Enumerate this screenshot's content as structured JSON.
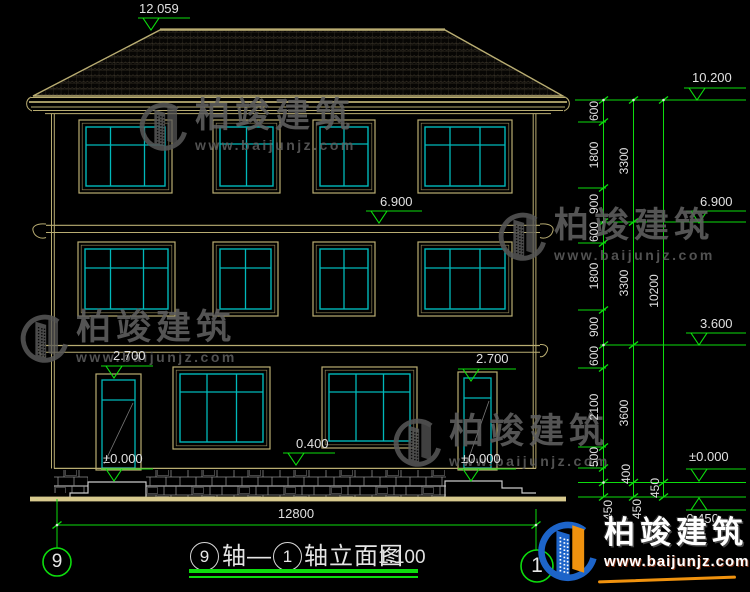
{
  "meta": {
    "kind": "architectural elevation CAD drawing"
  },
  "levels": {
    "ridge": "12.059",
    "eave": "10.200",
    "floor3": "6.900",
    "floor3_right": "6.900",
    "floor2_right": "3.600",
    "door_left": "2.700",
    "door_right": "2.700",
    "sill": "0.400",
    "zero_left": "±0.000",
    "zero_door_right": "±0.000",
    "zero_right": "±0.000",
    "below_ground": "-0.450"
  },
  "dims": {
    "overall_width": "12800",
    "chain_inner": [
      "600",
      "1800",
      "900",
      "600",
      "1800",
      "900",
      "600",
      "2100",
      "500",
      "450"
    ],
    "chain_middle": [
      "3300",
      "3300",
      "3600",
      "400",
      "450"
    ],
    "chain_outer": [
      "10200",
      "450"
    ]
  },
  "axes": {
    "left": "9",
    "right": "1"
  },
  "title": {
    "bubble_left": "9",
    "text_mid": "轴—",
    "bubble_right": "1",
    "text_main": "轴立面图",
    "scale": "1:100"
  },
  "watermark": {
    "name": "柏竣建筑",
    "url": "www.baijunjz.com"
  },
  "logo": {
    "name": "柏竣建筑",
    "url": "www.baijunjz.com"
  },
  "colors": {
    "line_tan": "#b9ad72",
    "glass_cyan": "#00b8ba",
    "dim_green": "#0ddd0d",
    "text_white": "#e0e0e0",
    "logo_blue": "#1d64c9",
    "logo_orange": "#f0920e"
  }
}
